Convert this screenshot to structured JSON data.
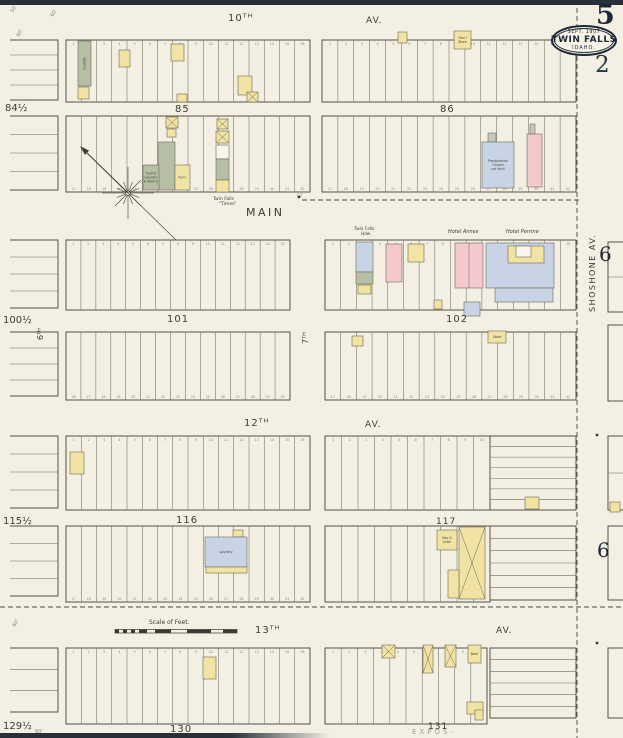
{
  "sheet": {
    "sheet_number": "5",
    "page_number": "2",
    "adjacent_sheet_refs": {
      "upper": "6",
      "lower": "6"
    },
    "badge": {
      "date": "SEPT. 1907",
      "city": "TWIN FALLS",
      "state": "IDAHO."
    }
  },
  "colors": {
    "paper": "#f3efe2",
    "ink": "#45423a",
    "navy": "#1d2936",
    "y": "#f0e3a4",
    "p": "#f3c9ce",
    "b": "#c8d4e6",
    "o": "#b6bfa6",
    "g": "#c6c8bf",
    "w": "#f8f5ea"
  },
  "map": {
    "labels": [
      {
        "t": "10ᵀᴴ",
        "x": 228,
        "y": 21,
        "s": 10,
        "ls": 1,
        "k": "street"
      },
      {
        "t": "AV.",
        "x": 366,
        "y": 23,
        "s": 9,
        "ls": 1,
        "k": "street"
      },
      {
        "t": "MAIN",
        "x": 246,
        "y": 216,
        "s": 11,
        "ls": 2.5,
        "k": "street"
      },
      {
        "t": "12ᵀᴴ",
        "x": 244,
        "y": 426,
        "s": 10,
        "ls": 1,
        "k": "street"
      },
      {
        "t": "AV.",
        "x": 365,
        "y": 427,
        "s": 9,
        "ls": 1,
        "k": "street"
      },
      {
        "t": "13ᵀᴴ",
        "x": 255,
        "y": 633,
        "s": 10,
        "ls": 1,
        "k": "street"
      },
      {
        "t": "AV.",
        "x": 496,
        "y": 633,
        "s": 9,
        "ls": 1,
        "k": "street"
      },
      {
        "t": "7ᵀᴴ",
        "x": 308,
        "y": 344,
        "s": 8,
        "r": -90,
        "k": "street"
      },
      {
        "t": "6ᵀᴴ",
        "x": 43,
        "y": 340,
        "s": 8,
        "r": -90,
        "k": "street"
      },
      {
        "t": "SHOSHONE  AV.",
        "x": 595,
        "y": 312,
        "s": 8,
        "r": -90,
        "ls": 1.5,
        "k": "street"
      },
      {
        "t": "85",
        "x": 175,
        "y": 112,
        "s": 10,
        "ls": 1,
        "k": "block"
      },
      {
        "t": "86",
        "x": 440,
        "y": 112,
        "s": 10,
        "ls": 1,
        "k": "block"
      },
      {
        "t": "101",
        "x": 167,
        "y": 322,
        "s": 10,
        "ls": 1,
        "k": "block"
      },
      {
        "t": "102",
        "x": 446,
        "y": 322,
        "s": 10,
        "ls": 1,
        "k": "block"
      },
      {
        "t": "116",
        "x": 176,
        "y": 523,
        "s": 10,
        "ls": 1,
        "k": "block"
      },
      {
        "t": "117",
        "x": 436,
        "y": 524,
        "s": 9,
        "ls": 1,
        "k": "block"
      },
      {
        "t": "130",
        "x": 170,
        "y": 732,
        "s": 10,
        "ls": 1,
        "k": "block"
      },
      {
        "t": "131",
        "x": 428,
        "y": 729,
        "s": 9,
        "ls": 1,
        "k": "block"
      },
      {
        "t": "84½",
        "x": 5,
        "y": 111,
        "s": 10,
        "k": "margin"
      },
      {
        "t": "100½",
        "x": 3,
        "y": 323,
        "s": 10,
        "k": "margin"
      },
      {
        "t": "115½",
        "x": 3,
        "y": 524,
        "s": 10,
        "k": "margin"
      },
      {
        "t": "129½",
        "x": 3,
        "y": 729,
        "s": 10,
        "k": "margin"
      },
      {
        "t": "Scale of Feet.",
        "x": 149,
        "y": 624,
        "s": 6,
        "k": "caption"
      },
      {
        "t": "Hotel  Annex",
        "x": 448,
        "y": 233,
        "s": 5,
        "i": 1,
        "k": "caption"
      },
      {
        "t": "Hotel  Perrine",
        "x": 506,
        "y": 233,
        "s": 5,
        "i": 1,
        "k": "caption"
      },
      {
        "t": "Twin Falls",
        "x": 354,
        "y": 230,
        "s": 4.2,
        "i": 1,
        "k": "caption"
      },
      {
        "t": "Hdw.",
        "x": 361,
        "y": 235,
        "s": 4.2,
        "i": 1,
        "k": "caption"
      },
      {
        "t": "Twin Falls",
        "x": 213,
        "y": 200,
        "s": 4.5,
        "k": "caption"
      },
      {
        "t": "\"Times\"",
        "x": 219,
        "y": 205,
        "s": 4.5,
        "k": "caption"
      },
      {
        "t": "EXPOS-",
        "x": 412,
        "y": 734,
        "s": 7,
        "ls": 3,
        "o": 0.45,
        "k": "caption"
      },
      {
        "t": "50'",
        "x": 13,
        "y": 13,
        "s": 5,
        "r": -60,
        "o": 0.6,
        "k": "dim"
      },
      {
        "t": "60'",
        "x": 53,
        "y": 17,
        "s": 5,
        "r": -60,
        "o": 0.6,
        "k": "dim"
      },
      {
        "t": "60'",
        "x": 19,
        "y": 37,
        "s": 5,
        "r": -60,
        "o": 0.6,
        "k": "dim"
      },
      {
        "t": "60'",
        "x": 15,
        "y": 627,
        "s": 5,
        "r": -60,
        "o": 0.6,
        "k": "dim"
      },
      {
        "t": "60'",
        "x": 35,
        "y": 733,
        "s": 5,
        "o": 0.6,
        "k": "dim"
      },
      {
        "t": "60'",
        "x": 297,
        "y": 197,
        "s": 4,
        "o": 0.5,
        "k": "dim"
      }
    ],
    "lot_blocks": [
      {
        "x": 66,
        "y": 40,
        "w": 244,
        "h": 62,
        "n": 16,
        "nt": 1
      },
      {
        "x": 322,
        "y": 40,
        "w": 254,
        "h": 62,
        "n": 16,
        "nt": 1
      },
      {
        "x": 66,
        "y": 116,
        "w": 244,
        "h": 76,
        "n": 16,
        "nb": 17
      },
      {
        "x": 322,
        "y": 116,
        "w": 254,
        "h": 76,
        "n": 16,
        "nb": 17
      },
      {
        "x": 66,
        "y": 240,
        "w": 224,
        "h": 70,
        "n": 15,
        "nt": 1
      },
      {
        "x": 325,
        "y": 240,
        "w": 251,
        "h": 70,
        "n": 16,
        "nt": 1
      },
      {
        "x": 66,
        "y": 332,
        "w": 224,
        "h": 68,
        "n": 15,
        "nb": 16
      },
      {
        "x": 325,
        "y": 332,
        "w": 251,
        "h": 68,
        "n": 16,
        "nb": 17
      },
      {
        "x": 66,
        "y": 436,
        "w": 244,
        "h": 74,
        "n": 16,
        "nt": 1
      },
      {
        "x": 325,
        "y": 436,
        "w": 165,
        "h": 74,
        "n": 10,
        "nt": 1
      },
      {
        "x": 490,
        "y": 436,
        "w": 86,
        "h": 74,
        "n": 7,
        "horiz": 1
      },
      {
        "x": 66,
        "y": 526,
        "w": 244,
        "h": 76,
        "n": 16,
        "nb": 17
      },
      {
        "x": 325,
        "y": 526,
        "w": 165,
        "h": 76,
        "n": 10
      },
      {
        "x": 490,
        "y": 526,
        "w": 86,
        "h": 74,
        "n": 6,
        "horiz": 1
      },
      {
        "x": 66,
        "y": 648,
        "w": 244,
        "h": 76,
        "n": 16,
        "nt": 1
      },
      {
        "x": 325,
        "y": 648,
        "w": 162,
        "h": 76,
        "n": 10,
        "nt": 1
      },
      {
        "x": 490,
        "y": 648,
        "w": 86,
        "h": 70,
        "n": 6,
        "horiz": 1
      },
      {
        "x": 10,
        "y": 40,
        "w": 48,
        "h": 60,
        "open": "l",
        "hl": 3
      },
      {
        "x": 10,
        "y": 116,
        "w": 48,
        "h": 74,
        "open": "l",
        "hl": 3
      },
      {
        "x": 10,
        "y": 240,
        "w": 48,
        "h": 68,
        "open": "l",
        "hl": 3
      },
      {
        "x": 10,
        "y": 332,
        "w": 48,
        "h": 64,
        "open": "l",
        "hl": 3
      },
      {
        "x": 10,
        "y": 436,
        "w": 48,
        "h": 72,
        "open": "l",
        "hl": 3
      },
      {
        "x": 10,
        "y": 526,
        "w": 48,
        "h": 70,
        "open": "l",
        "hl": 3
      },
      {
        "x": 10,
        "y": 648,
        "w": 48,
        "h": 64,
        "open": "l",
        "hl": 2
      },
      {
        "x": 608,
        "y": 242,
        "w": 15,
        "h": 70,
        "open": "r",
        "hl": 1
      },
      {
        "x": 608,
        "y": 325,
        "w": 15,
        "h": 76,
        "open": "r",
        "hl": 0
      },
      {
        "x": 608,
        "y": 436,
        "w": 15,
        "h": 74,
        "open": "r",
        "hl": 1
      },
      {
        "x": 608,
        "y": 526,
        "w": 15,
        "h": 74,
        "open": "r",
        "hl": 0
      },
      {
        "x": 608,
        "y": 648,
        "w": 15,
        "h": 70,
        "open": "r",
        "hl": 0
      }
    ],
    "buildings": [
      {
        "x": 78,
        "y": 41,
        "w": 13,
        "h": 45,
        "c": "o",
        "lines": [
          "Laundry"
        ],
        "lr": -90
      },
      {
        "x": 78,
        "y": 87,
        "w": 11,
        "h": 12,
        "c": "y"
      },
      {
        "x": 119,
        "y": 50,
        "w": 11,
        "h": 17,
        "c": "y"
      },
      {
        "x": 171,
        "y": 44,
        "w": 13,
        "h": 17,
        "c": "y"
      },
      {
        "x": 238,
        "y": 76,
        "w": 14,
        "h": 19,
        "c": "y"
      },
      {
        "x": 247,
        "y": 92,
        "w": 11,
        "h": 10,
        "c": "y",
        "cross": 1
      },
      {
        "x": 177,
        "y": 94,
        "w": 10,
        "h": 8,
        "c": "y"
      },
      {
        "x": 398,
        "y": 32,
        "w": 9,
        "h": 11,
        "c": "y"
      },
      {
        "x": 454,
        "y": 31,
        "w": 17,
        "h": 18,
        "c": "y",
        "lines": [
          "Gen'l",
          "Store"
        ]
      },
      {
        "x": 166,
        "y": 117,
        "w": 12,
        "h": 11,
        "c": "y",
        "cross": 1
      },
      {
        "x": 167,
        "y": 129,
        "w": 9,
        "h": 8,
        "c": "y"
      },
      {
        "x": 217,
        "y": 119,
        "w": 11,
        "h": 10,
        "c": "y",
        "cross": 1
      },
      {
        "x": 158,
        "y": 142,
        "w": 17,
        "h": 48,
        "c": "o"
      },
      {
        "x": 143,
        "y": 165,
        "w": 16,
        "h": 25,
        "c": "o",
        "lines": [
          "Furn'd",
          "Laundry",
          "& Rooms"
        ]
      },
      {
        "x": 175,
        "y": 165,
        "w": 15,
        "h": 25,
        "c": "y",
        "lines": [
          "Furn."
        ]
      },
      {
        "x": 216,
        "y": 131,
        "w": 13,
        "h": 12,
        "c": "y",
        "cross": 1
      },
      {
        "x": 216,
        "y": 145,
        "w": 13,
        "h": 14,
        "c": "w"
      },
      {
        "x": 216,
        "y": 159,
        "w": 13,
        "h": 21,
        "c": "o"
      },
      {
        "x": 216,
        "y": 180,
        "w": 13,
        "h": 12,
        "c": "y"
      },
      {
        "x": 488,
        "y": 133,
        "w": 8,
        "h": 9,
        "c": "g"
      },
      {
        "x": 482,
        "y": 142,
        "w": 32,
        "h": 46,
        "c": "b",
        "lines": [
          "Presbyterian",
          "Church",
          "not fin'd"
        ]
      },
      {
        "x": 530,
        "y": 124,
        "w": 5,
        "h": 10,
        "c": "g"
      },
      {
        "x": 527,
        "y": 134,
        "w": 15,
        "h": 53,
        "c": "p"
      },
      {
        "x": 356,
        "y": 242,
        "w": 17,
        "h": 30,
        "c": "b"
      },
      {
        "x": 356,
        "y": 272,
        "w": 17,
        "h": 12,
        "c": "o"
      },
      {
        "x": 358,
        "y": 285,
        "w": 13,
        "h": 9,
        "c": "y"
      },
      {
        "x": 386,
        "y": 244,
        "w": 16,
        "h": 38,
        "c": "p"
      },
      {
        "x": 408,
        "y": 244,
        "w": 16,
        "h": 18,
        "c": "y"
      },
      {
        "x": 455,
        "y": 243,
        "w": 28,
        "h": 45,
        "c": "p",
        "vline": 1
      },
      {
        "x": 486,
        "y": 243,
        "w": 68,
        "h": 45,
        "c": "b"
      },
      {
        "x": 508,
        "y": 246,
        "w": 36,
        "h": 17,
        "c": "y"
      },
      {
        "x": 516,
        "y": 246,
        "w": 15,
        "h": 11,
        "c": "w"
      },
      {
        "x": 495,
        "y": 288,
        "w": 58,
        "h": 14,
        "c": "b"
      },
      {
        "x": 464,
        "y": 302,
        "w": 16,
        "h": 14,
        "c": "b"
      },
      {
        "x": 434,
        "y": 300,
        "w": 8,
        "h": 9,
        "c": "y"
      },
      {
        "x": 352,
        "y": 336,
        "w": 11,
        "h": 10,
        "c": "y"
      },
      {
        "x": 488,
        "y": 331,
        "w": 18,
        "h": 12,
        "c": "y",
        "lines": [
          "Store"
        ]
      },
      {
        "x": 70,
        "y": 452,
        "w": 14,
        "h": 22,
        "c": "y"
      },
      {
        "x": 233,
        "y": 530,
        "w": 10,
        "h": 7,
        "c": "y"
      },
      {
        "x": 205,
        "y": 537,
        "w": 42,
        "h": 30,
        "c": "b",
        "lines": [
          "Laundry"
        ]
      },
      {
        "x": 206,
        "y": 567,
        "w": 41,
        "h": 6,
        "c": "y"
      },
      {
        "x": 525,
        "y": 497,
        "w": 14,
        "h": 12,
        "c": "y"
      },
      {
        "x": 610,
        "y": 502,
        "w": 10,
        "h": 10,
        "c": "y"
      },
      {
        "x": 437,
        "y": 530,
        "w": 20,
        "h": 20,
        "c": "y",
        "lines": [
          "Hay &",
          "Grain"
        ]
      },
      {
        "x": 459,
        "y": 527,
        "w": 26,
        "h": 72,
        "c": "y",
        "cross": 1
      },
      {
        "x": 448,
        "y": 570,
        "w": 11,
        "h": 28,
        "c": "y"
      },
      {
        "x": 203,
        "y": 657,
        "w": 13,
        "h": 22,
        "c": "y"
      },
      {
        "x": 382,
        "y": 645,
        "w": 13,
        "h": 13,
        "c": "y",
        "cross": 1
      },
      {
        "x": 423,
        "y": 645,
        "w": 10,
        "h": 28,
        "c": "y",
        "cross": 1
      },
      {
        "x": 445,
        "y": 645,
        "w": 11,
        "h": 22,
        "c": "y",
        "cross": 1
      },
      {
        "x": 468,
        "y": 645,
        "w": 13,
        "h": 18,
        "c": "y",
        "lines": [
          "Barn"
        ]
      },
      {
        "x": 467,
        "y": 702,
        "w": 16,
        "h": 12,
        "c": "y"
      },
      {
        "x": 475,
        "y": 710,
        "w": 8,
        "h": 10,
        "c": "y"
      }
    ],
    "dashed_lines": [
      {
        "x1": 577,
        "y1": 0,
        "x2": 577,
        "y2": 738
      },
      {
        "x1": 0,
        "y1": 607,
        "x2": 623,
        "y2": 607
      },
      {
        "x1": 302,
        "y1": 200,
        "x2": 580,
        "y2": 200
      }
    ],
    "dots": [
      {
        "x": 299,
        "y": 197
      },
      {
        "x": 597,
        "y": 435
      },
      {
        "x": 597,
        "y": 643
      }
    ]
  }
}
